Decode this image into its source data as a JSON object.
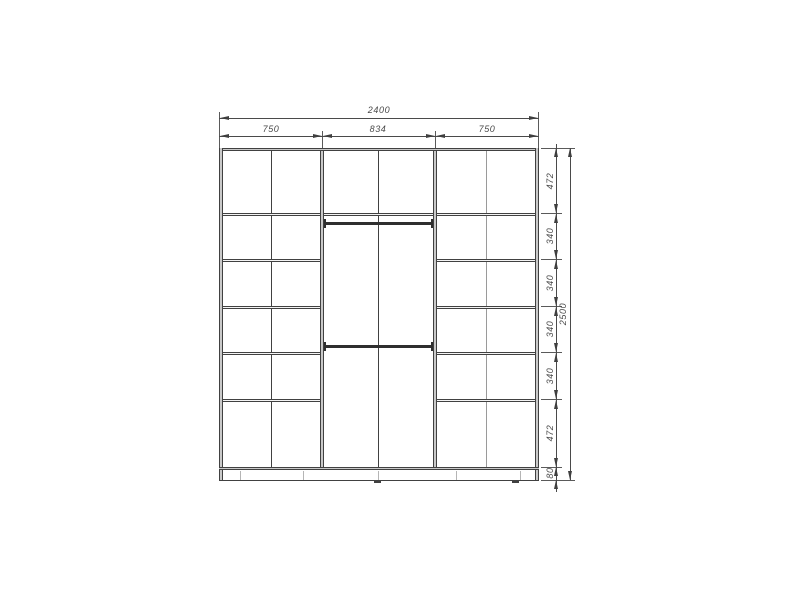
{
  "drawing": {
    "type": "wardrobe-interior-elevation",
    "dims_top": {
      "total": "2400",
      "segments": [
        "750",
        "834",
        "750"
      ]
    },
    "dims_right": {
      "total": "2500",
      "segments": [
        "472",
        "340",
        "340",
        "340",
        "340",
        "472",
        "80"
      ]
    },
    "colors": {
      "line": "#414141",
      "panel_fill": "#c9c9c9",
      "dimension": "#4a4a4a",
      "background": "#ffffff"
    }
  }
}
